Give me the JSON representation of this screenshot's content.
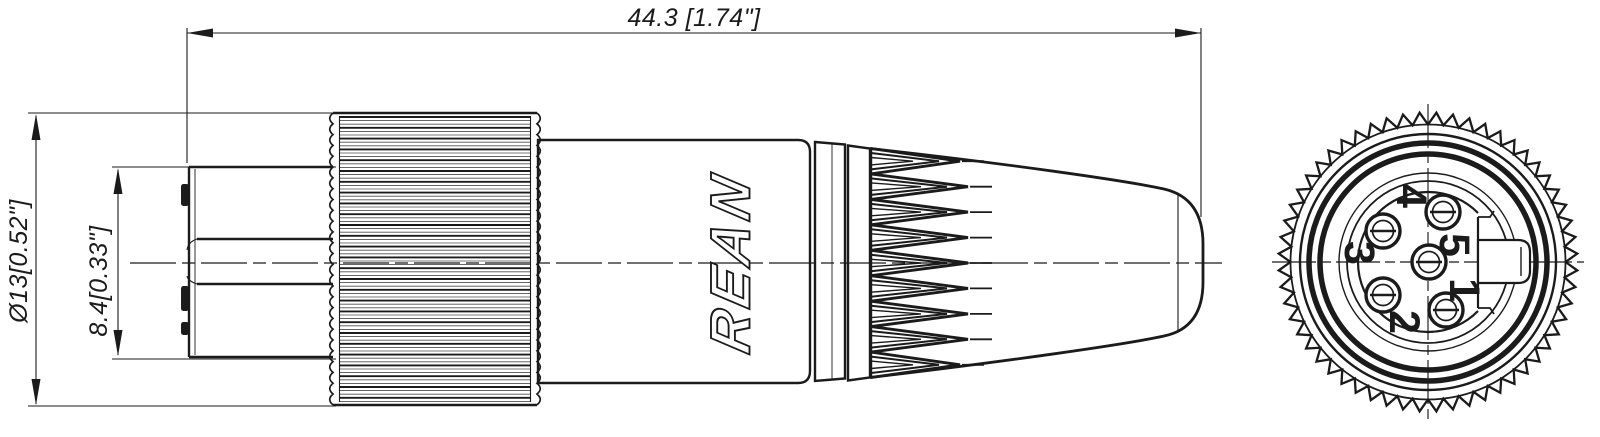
{
  "drawing": {
    "dims": {
      "overall_length": "44.3 [1.74\"]",
      "body_diameter": "Ø13[0.52\"]",
      "front_diameter": "8.4[0.33\"]"
    },
    "brand": "REAN",
    "end_view_pins": {
      "p1": "1",
      "p2": "2",
      "p3": "3",
      "p4": "4",
      "p5": "5"
    },
    "colors": {
      "line": "#1b1b1b",
      "background": "#ffffff"
    }
  }
}
